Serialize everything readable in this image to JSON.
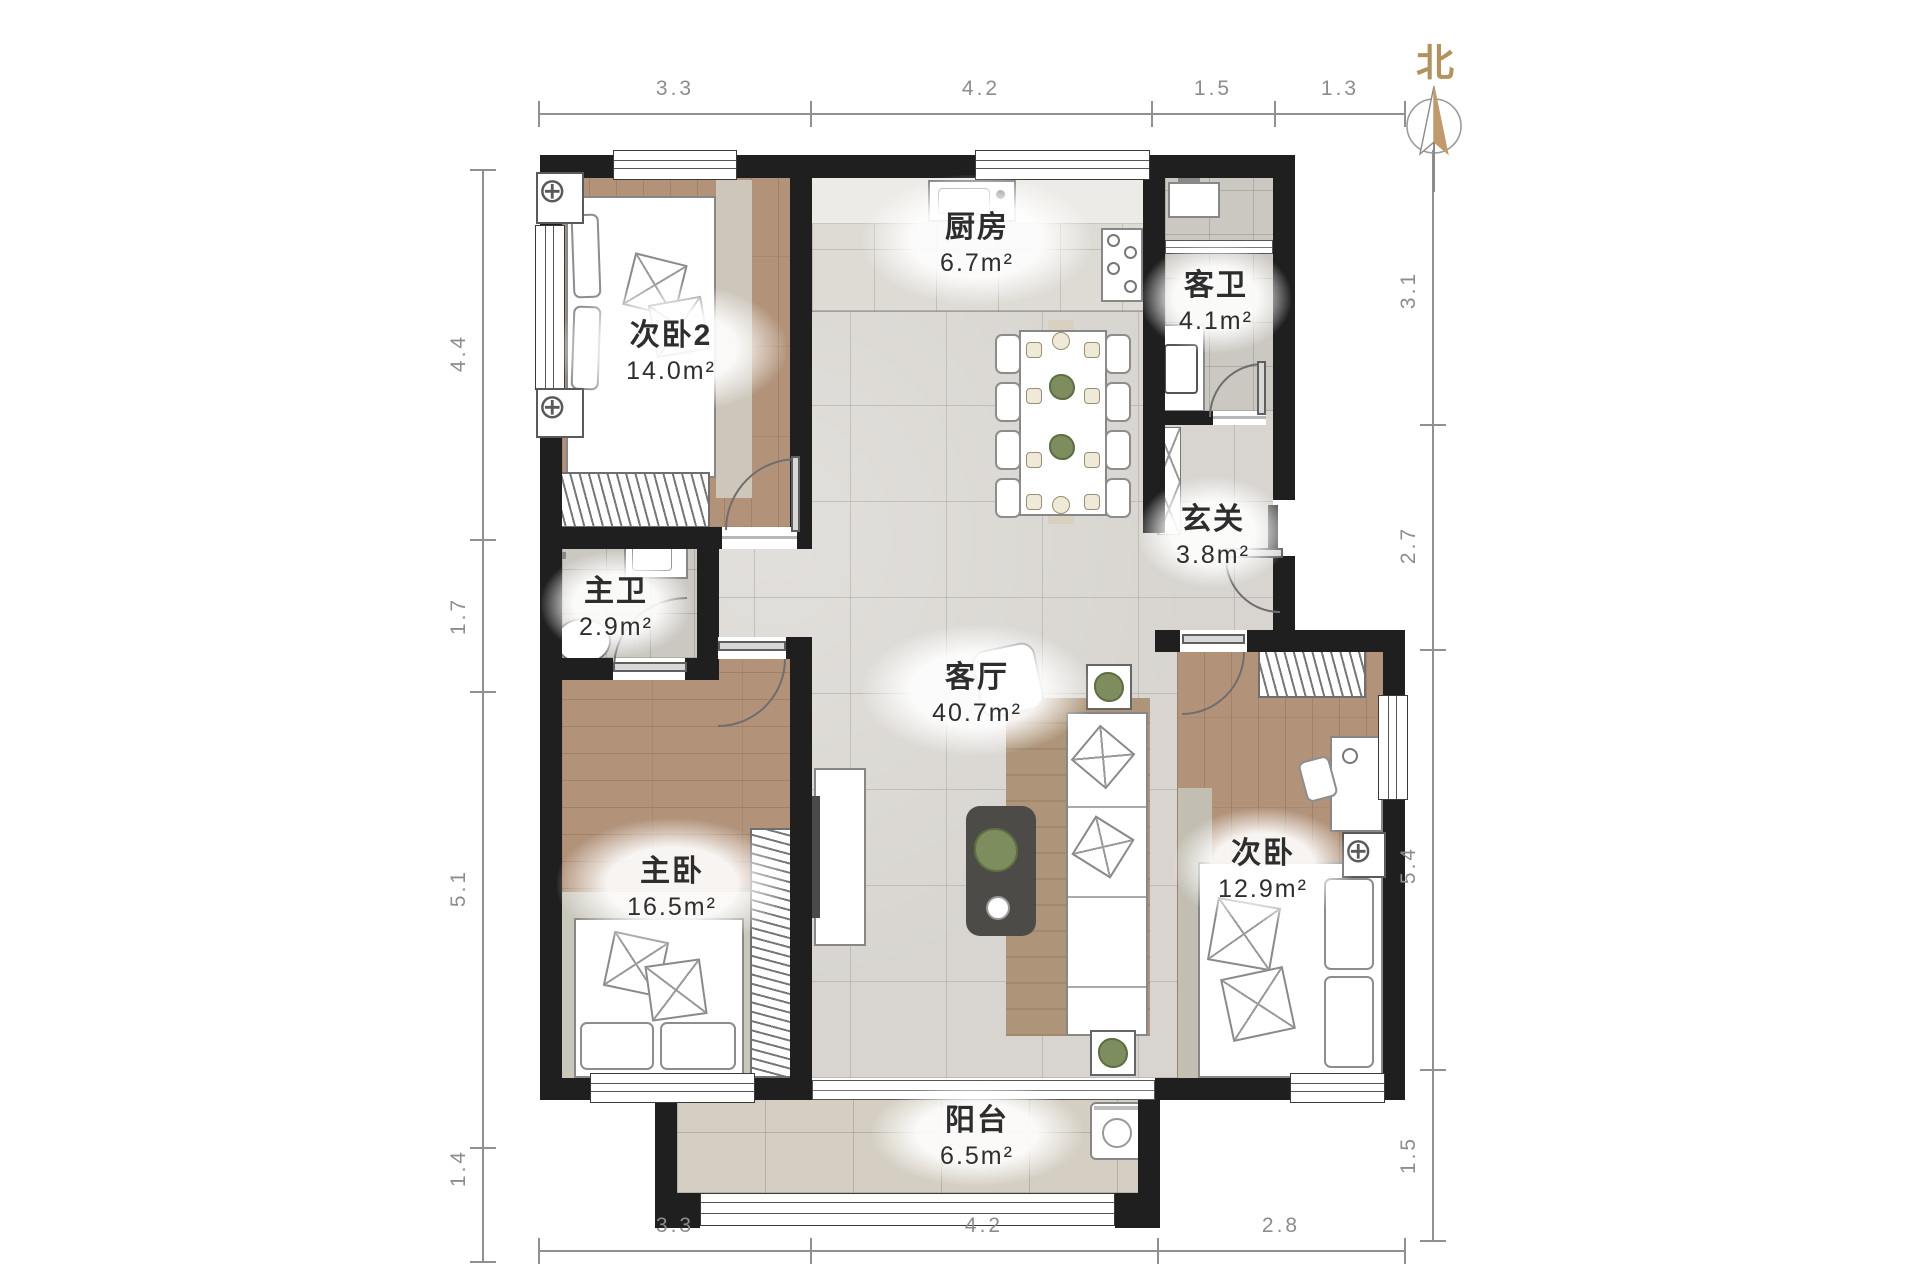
{
  "compass": {
    "label": "北"
  },
  "rooms": [
    {
      "id": "kitchen",
      "name": "厨房",
      "area": "6.7m²"
    },
    {
      "id": "guest-bathroom",
      "name": "客卫",
      "area": "4.1m²"
    },
    {
      "id": "bedroom-2",
      "name": "次卧2",
      "area": "14.0m²"
    },
    {
      "id": "entry-hall",
      "name": "玄关",
      "area": "3.8m²"
    },
    {
      "id": "master-bathroom",
      "name": "主卫",
      "area": "2.9m²"
    },
    {
      "id": "living-room",
      "name": "客厅",
      "area": "40.7m²"
    },
    {
      "id": "master-bedroom",
      "name": "主卧",
      "area": "16.5m²"
    },
    {
      "id": "bedroom",
      "name": "次卧",
      "area": "12.9m²"
    },
    {
      "id": "balcony",
      "name": "阳台",
      "area": "6.5m²"
    }
  ],
  "dimensions_m": {
    "top": [
      "3.3",
      "4.2",
      "1.5",
      "1.3"
    ],
    "bottom": [
      "3.3",
      "4.2",
      "2.8"
    ],
    "left": [
      "4.4",
      "1.7",
      "5.1",
      "1.4"
    ],
    "right": [
      "3.1",
      "2.7",
      "5.4",
      "1.5"
    ]
  },
  "colors": {
    "wall": "#1f1f1f",
    "wood_floor": "#b2937a",
    "marble_floor": "#d8d5d0",
    "north_accent": "#bd9a6a",
    "dimension_text": "#8d8d8d",
    "label_text": "#2d2d2d"
  }
}
